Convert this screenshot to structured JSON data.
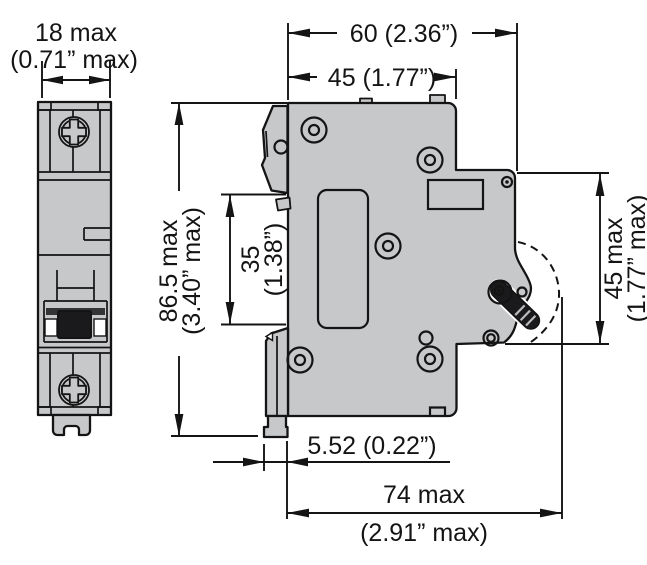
{
  "colors": {
    "body": "#c7c8ca",
    "line": "#141414",
    "toggle": "#1a1a1c",
    "background": "#ffffff"
  },
  "dims": {
    "front_width": {
      "metric": "18 max",
      "imperial": "(0.71” max)"
    },
    "depth_total": {
      "label": "60 (2.36”)"
    },
    "depth_upper": {
      "label": "45 (1.77”)"
    },
    "height_total": {
      "metric": "86.5 max",
      "imperial": "(3.40” max)"
    },
    "rail_recess": {
      "metric": "35",
      "imperial": "(1.38”)"
    },
    "front_height": {
      "metric": "45 max",
      "imperial": "(1.77” max)"
    },
    "clip_offset": {
      "label": "5.52 (0.22”)"
    },
    "depth_overall": {
      "metric": "74 max",
      "imperial": "(2.91” max)"
    }
  }
}
